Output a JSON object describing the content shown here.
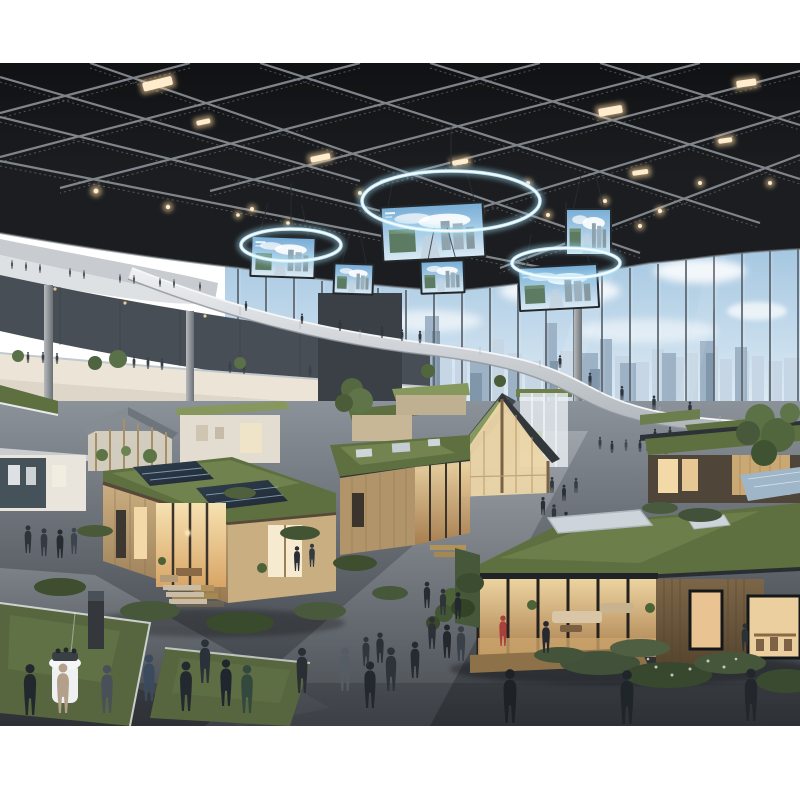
{
  "image": {
    "type": "photorealistic-render",
    "alt": "Indoor sustainable-housing expo hall: tiny model homes with green roofs and solar panels, business visitors, circular LED ring displays with hanging banner screens under a dark truss ceiling, and a glass curtain wall revealing a city skyline.",
    "width": 800,
    "height": 800,
    "content_top": 63,
    "content_bottom": 726
  },
  "colors": {
    "margin_white": "#ffffff",
    "ceiling": "#1b1d20",
    "truss": "#9aa0a6",
    "light_warm": "#ffd9a0",
    "ring_glow": "#9fdcf2",
    "sky_top": "#9fc3df",
    "sky_bottom": "#e9f2f8",
    "cloud": "#ffffff",
    "skyline_far": "#c6d6e4",
    "skyline_near": "#9cb1c5",
    "skyline_dark": "#7d93a8",
    "mullion": "#5a646d",
    "wall_dark": "#484e55",
    "balcony_white": "#dde1e4",
    "gallery_warm": "#ece5d7",
    "lower_wall": "#ddd6c9",
    "core_dark": "#3b4046",
    "bridge_top": "#e2e5e8",
    "column": "#9aa0a5",
    "floor_light": "#8b9299",
    "floor_dark": "#33373c",
    "path_light": "#aab0b6",
    "wood_main": "#b2946a",
    "wood_light": "#c9ae82",
    "wood_dusk": "#6a5640",
    "interior_warm": "#f3d9a8",
    "green_roof": "#5e7040",
    "green_roof_light": "#87985f",
    "shrub_dark": "#3e4e2e",
    "solar_dark": "#27313d",
    "solar_blue": "#9fb6c8",
    "frame_dark": "#23282c",
    "deck_wood": "#8d7148",
    "person_dark": "#262b31",
    "accent_red": "#a8403c",
    "accent_beige": "#b3a08a",
    "accent_green": "#33493e",
    "screen_sky": "#7fb2d8",
    "screen_green": "#5d7a62",
    "glass_sill": "#d6dce0",
    "planter_grass": "#57663e"
  },
  "scene": {
    "counts": {
      "ring_displays": 3,
      "banner_screens": 6,
      "model_houses": 13,
      "visitor_figures": 88,
      "city_towers": 41
    },
    "rings": [
      [
        451,
        138,
        89,
        30
      ],
      [
        291,
        182,
        50,
        16
      ],
      [
        566,
        200,
        54,
        15
      ]
    ],
    "screens": [
      [
        383,
        143,
        100,
        52,
        -3
      ],
      [
        252,
        175,
        62,
        38,
        2
      ],
      [
        335,
        202,
        37,
        28,
        2
      ],
      [
        422,
        199,
        41,
        30,
        -2
      ],
      [
        520,
        204,
        77,
        41,
        -3
      ],
      [
        567,
        147,
        43,
        44,
        0
      ]
    ],
    "mullions": [
      [
        238,
        206
      ],
      [
        266,
        210
      ],
      [
        294,
        214
      ],
      [
        322,
        218
      ],
      [
        350,
        222
      ],
      [
        378,
        225
      ],
      [
        406,
        227
      ],
      [
        434,
        228
      ],
      [
        462,
        227
      ],
      [
        490,
        225
      ],
      [
        518,
        222
      ],
      [
        546,
        218
      ],
      [
        574,
        214
      ],
      [
        602,
        210
      ],
      [
        630,
        205
      ],
      [
        658,
        201
      ],
      [
        686,
        197
      ],
      [
        714,
        193
      ],
      [
        742,
        190
      ],
      [
        770,
        188
      ],
      [
        798,
        186
      ]
    ],
    "towers_far": [
      [
        362,
        298,
        16
      ],
      [
        380,
        284,
        12
      ],
      [
        398,
        300,
        20
      ],
      [
        420,
        268,
        10
      ],
      [
        436,
        292,
        16
      ],
      [
        455,
        283,
        12
      ],
      [
        470,
        298,
        18
      ],
      [
        492,
        276,
        12
      ],
      [
        508,
        290,
        14
      ],
      [
        525,
        298,
        16
      ],
      [
        543,
        266,
        12
      ],
      [
        560,
        288,
        14
      ],
      [
        578,
        294,
        20
      ],
      [
        600,
        280,
        12
      ],
      [
        615,
        293,
        16
      ],
      [
        635,
        299,
        14
      ],
      [
        652,
        286,
        12
      ],
      [
        668,
        294,
        16
      ],
      [
        686,
        290,
        12
      ],
      [
        702,
        283,
        16
      ],
      [
        720,
        296,
        12
      ],
      [
        735,
        288,
        14
      ],
      [
        752,
        293,
        12
      ],
      [
        768,
        298,
        14
      ],
      [
        784,
        295,
        16
      ]
    ],
    "towers_near": [
      [
        425,
        253,
        14
      ],
      [
        545,
        260,
        12
      ],
      [
        600,
        276,
        12
      ],
      [
        700,
        278,
        14
      ],
      [
        470,
        293,
        20
      ],
      [
        735,
        284,
        12
      ],
      [
        382,
        280,
        12
      ],
      [
        662,
        290,
        14
      ],
      [
        578,
        290,
        20
      ],
      [
        508,
        300,
        12
      ],
      [
        620,
        300,
        16
      ]
    ],
    "towers_dark": [
      [
        432,
        268,
        8
      ],
      [
        706,
        290,
        8
      ],
      [
        550,
        298,
        8
      ],
      [
        590,
        306,
        10
      ],
      [
        470,
        310,
        12
      ]
    ],
    "light_bars": [
      [
        142,
        20,
        30,
        9,
        -14
      ],
      [
        598,
        46,
        24,
        8,
        -10
      ],
      [
        736,
        18,
        20,
        7,
        -8
      ],
      [
        310,
        94,
        20,
        6,
        -12
      ],
      [
        632,
        108,
        16,
        5,
        -8
      ],
      [
        718,
        76,
        14,
        5,
        -8
      ],
      [
        196,
        58,
        14,
        5,
        -12
      ],
      [
        452,
        98,
        16,
        5,
        -10
      ]
    ],
    "light_dots": [
      [
        96,
        128,
        2.5
      ],
      [
        168,
        144,
        2.2
      ],
      [
        252,
        146,
        2
      ],
      [
        420,
        158,
        2.2
      ],
      [
        478,
        148,
        2.2
      ],
      [
        548,
        152,
        2
      ],
      [
        605,
        138,
        2
      ],
      [
        660,
        148,
        2.2
      ],
      [
        700,
        120,
        2
      ],
      [
        770,
        120,
        2
      ],
      [
        360,
        130,
        2
      ],
      [
        528,
        120,
        2
      ],
      [
        288,
        160,
        1.8
      ],
      [
        238,
        152,
        1.8
      ],
      [
        585,
        160,
        2
      ],
      [
        640,
        163,
        2
      ]
    ],
    "people_back": [
      [
        12,
        206,
        0.3,
        "#525a63"
      ],
      [
        26,
        208,
        0.3,
        "#525a63"
      ],
      [
        40,
        210,
        0.3,
        "#525a63"
      ],
      [
        70,
        214,
        0.3,
        "#525a63"
      ],
      [
        84,
        216,
        0.3,
        "#525a63"
      ],
      [
        120,
        220,
        0.3,
        "#525a63"
      ],
      [
        134,
        221,
        0.3,
        "#525a63"
      ],
      [
        160,
        224,
        0.3,
        "#525a63"
      ],
      [
        174,
        225,
        0.3,
        "#525a63"
      ],
      [
        200,
        228,
        0.3,
        "#525a63"
      ],
      [
        28,
        300,
        0.38,
        "#3a4149"
      ],
      [
        43,
        300,
        0.38,
        "#3a4149"
      ],
      [
        57,
        301,
        0.38,
        "#3a4149"
      ],
      [
        120,
        304,
        0.4,
        "#3a4149"
      ],
      [
        134,
        305,
        0.4,
        "#3a4149"
      ],
      [
        148,
        306,
        0.4,
        "#3a4149"
      ],
      [
        162,
        307,
        0.4,
        "#3a4149"
      ],
      [
        230,
        310,
        0.4,
        "#3a4149"
      ],
      [
        244,
        311,
        0.4,
        "#3a4149"
      ],
      [
        310,
        314,
        0.42,
        "#3a4149"
      ],
      [
        324,
        314,
        0.42,
        "#3a4149"
      ],
      [
        395,
        318,
        0.42,
        "#3a4149"
      ],
      [
        246,
        248,
        0.34,
        "#2f353d"
      ],
      [
        302,
        261,
        0.36,
        "#2f353d"
      ],
      [
        340,
        268,
        0.38,
        "#2f353d"
      ],
      [
        382,
        275,
        0.4,
        "#2f353d"
      ],
      [
        402,
        278,
        0.4,
        "#2f353d"
      ],
      [
        420,
        280,
        0.42,
        "#2f353d"
      ],
      [
        560,
        305,
        0.44,
        "#2f353d"
      ],
      [
        590,
        323,
        0.46,
        "#2f353d"
      ],
      [
        622,
        337,
        0.48,
        "#2f353d"
      ],
      [
        654,
        347,
        0.5,
        "#2f353d"
      ],
      [
        690,
        353,
        0.5,
        "#2f353d"
      ],
      [
        600,
        386,
        0.42,
        "#39404a"
      ],
      [
        612,
        390,
        0.42,
        "#2e343c"
      ],
      [
        626,
        388,
        0.4,
        "#434a54"
      ],
      [
        640,
        389,
        0.42,
        "#2e343c"
      ],
      [
        662,
        385,
        0.4,
        "#39404a"
      ],
      [
        676,
        383,
        0.38,
        "#2e343c"
      ],
      [
        648,
        388,
        0.5,
        "#262b31"
      ],
      [
        657,
        390,
        0.5,
        "#31363d"
      ],
      [
        666,
        391,
        0.52,
        "#23282e"
      ],
      [
        675,
        389,
        0.5,
        "#2e333a"
      ],
      [
        684,
        387,
        0.48,
        "#262b31"
      ],
      [
        692,
        385,
        0.46,
        "#343941"
      ],
      [
        655,
        378,
        0.42,
        "#2b3037"
      ],
      [
        670,
        376,
        0.42,
        "#31363d"
      ],
      [
        543,
        452,
        0.62,
        "#2b3037"
      ],
      [
        554,
        460,
        0.64,
        "#32373e"
      ],
      [
        566,
        468,
        0.66,
        "#272c32"
      ],
      [
        578,
        476,
        0.68,
        "#2e333a"
      ],
      [
        590,
        485,
        0.7,
        "#24292f"
      ],
      [
        552,
        430,
        0.55,
        "#333840"
      ],
      [
        564,
        438,
        0.56,
        "#2a2f36"
      ],
      [
        576,
        430,
        0.52,
        "#383d44"
      ]
    ],
    "people_front": [
      [
        30,
        652,
        1.75,
        "#23282e"
      ],
      [
        63,
        650,
        1.7,
        "#b3a08a"
      ],
      [
        107,
        650,
        1.65,
        "#4a5058"
      ],
      [
        149,
        638,
        1.6,
        "#3c4a5e"
      ],
      [
        186,
        648,
        1.7,
        "#24292f"
      ],
      [
        205,
        620,
        1.5,
        "#2b3139"
      ],
      [
        226,
        643,
        1.6,
        "#20262e"
      ],
      [
        247,
        650,
        1.65,
        "#33493e"
      ],
      [
        302,
        630,
        1.55,
        "#2a2f36"
      ],
      [
        345,
        628,
        1.5,
        "#565c64"
      ],
      [
        370,
        645,
        1.6,
        "#23282e"
      ],
      [
        391,
        628,
        1.5,
        "#2e333a"
      ],
      [
        510,
        660,
        1.85,
        "#1e2227"
      ],
      [
        627,
        661,
        1.85,
        "#20252a"
      ],
      [
        751,
        658,
        1.8,
        "#23272c"
      ],
      [
        28,
        490,
        0.95,
        "#2e333a"
      ],
      [
        44,
        493,
        0.95,
        "#343a42"
      ],
      [
        60,
        495,
        0.98,
        "#262b31"
      ],
      [
        74,
        491,
        0.9,
        "#3e444c"
      ],
      [
        432,
        586,
        1.1,
        "#2c3138"
      ],
      [
        447,
        595,
        1.15,
        "#23282d"
      ],
      [
        461,
        598,
        1.2,
        "#3a4047"
      ],
      [
        380,
        600,
        1.05,
        "#2b3037"
      ],
      [
        366,
        603,
        1.0,
        "#31363d"
      ],
      [
        415,
        615,
        1.25,
        "#262b31"
      ],
      [
        297,
        508,
        0.85,
        "#2a2f36"
      ],
      [
        312,
        504,
        0.8,
        "#343a41"
      ],
      [
        427,
        545,
        0.9,
        "#272c33"
      ],
      [
        443,
        552,
        0.9,
        "#2f343b"
      ],
      [
        458,
        556,
        0.92,
        "#23282e"
      ],
      [
        503,
        583,
        1.05,
        "#a8403c"
      ],
      [
        546,
        590,
        1.1,
        "#262a30"
      ],
      [
        745,
        588,
        0.95,
        "#2c3136"
      ]
    ],
    "trees": [
      [
        352,
        326,
        11,
        "#55683f"
      ],
      [
        360,
        338,
        13,
        "#60744a"
      ],
      [
        344,
        340,
        9,
        "#4b5d38"
      ],
      [
        118,
        296,
        9,
        "#5a7048"
      ],
      [
        95,
        300,
        7,
        "#4e6340"
      ],
      [
        760,
        356,
        15,
        "#5d7146"
      ],
      [
        778,
        372,
        17,
        "#52663e"
      ],
      [
        748,
        370,
        12,
        "#47593a"
      ],
      [
        790,
        350,
        10,
        "#60744a"
      ],
      [
        764,
        390,
        13,
        "#3f5232"
      ],
      [
        452,
        536,
        11,
        "#4e6238"
      ],
      [
        444,
        550,
        9,
        "#435634"
      ],
      [
        433,
        560,
        7,
        "#394a2c"
      ],
      [
        532,
        538,
        7,
        "#46583a"
      ],
      [
        648,
        540,
        6,
        "#3f5134"
      ],
      [
        18,
        293,
        6,
        "#5a7048"
      ],
      [
        240,
        300,
        6,
        "#5a7048"
      ],
      [
        428,
        308,
        7,
        "#52663e"
      ],
      [
        500,
        318,
        6,
        "#4b5d38"
      ]
    ],
    "shrubs": [
      [
        60,
        524,
        26,
        9,
        "#3e4e2e"
      ],
      [
        150,
        548,
        30,
        10,
        "#46573a"
      ],
      [
        240,
        560,
        34,
        11,
        "#3a4a2c"
      ],
      [
        320,
        548,
        26,
        9,
        "#49593b"
      ],
      [
        300,
        470,
        20,
        7,
        "#435434"
      ],
      [
        355,
        500,
        22,
        8,
        "#3e4e2e"
      ],
      [
        390,
        530,
        18,
        7,
        "#46573a"
      ],
      [
        240,
        430,
        16,
        6,
        "#50603d"
      ],
      [
        95,
        468,
        18,
        6,
        "#4a5a38"
      ],
      [
        600,
        600,
        40,
        12,
        "#42523a"
      ],
      [
        668,
        612,
        44,
        13,
        "#38482e"
      ],
      [
        730,
        600,
        36,
        11,
        "#46563a"
      ],
      [
        786,
        618,
        30,
        12,
        "#3a4a30"
      ],
      [
        640,
        585,
        30,
        9,
        "#4f5f42"
      ],
      [
        560,
        592,
        26,
        8,
        "#44543a"
      ],
      [
        470,
        520,
        14,
        10,
        "#3c4c30"
      ],
      [
        463,
        545,
        12,
        9,
        "#334326"
      ],
      [
        700,
        452,
        22,
        7,
        "#42523a"
      ],
      [
        660,
        445,
        18,
        6,
        "#4a5a3e"
      ]
    ]
  }
}
